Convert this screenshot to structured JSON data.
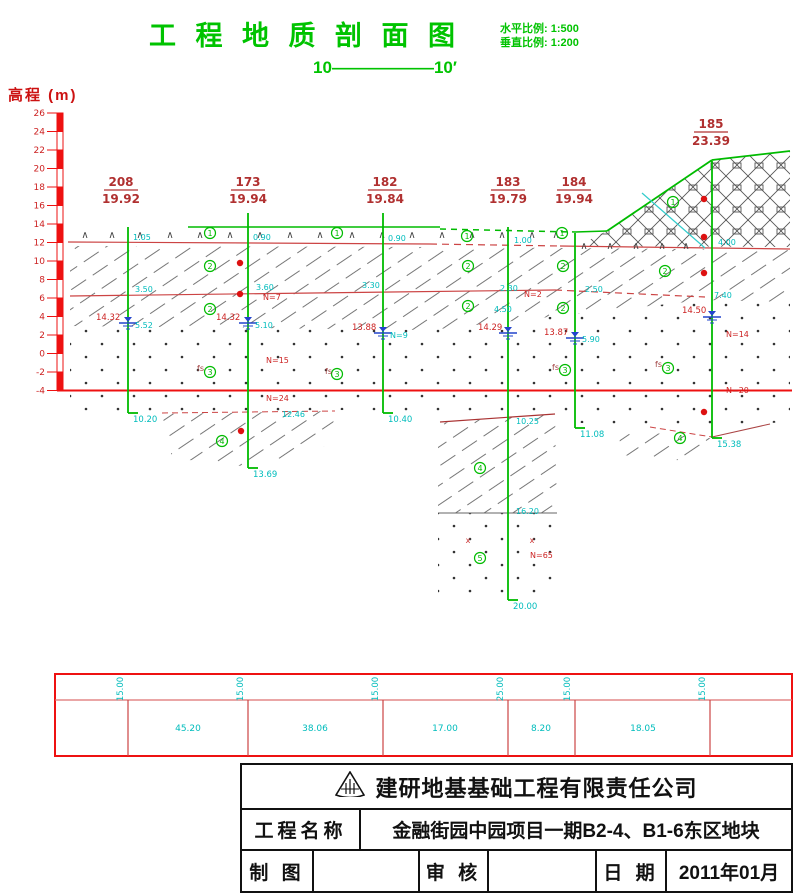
{
  "title": {
    "text": "工 程 地 质 剖 面 图",
    "scale_h": "水平比例: 1:500",
    "scale_v": "垂直比例: 1:200",
    "section": "10——————10′"
  },
  "axis": {
    "label": "高程 (m)",
    "max": 26,
    "min": -4,
    "step": 2,
    "x": 57,
    "bar_w": 6,
    "y_top": 113,
    "px_per_m": 9.25
  },
  "colors": {
    "green": "#00bb00",
    "red_line": "#cc4444",
    "axis_red": "#ee1111",
    "dark_red": "#b03030",
    "cyan": "#00bcbc",
    "blue": "#2244cc",
    "gray": "#666666",
    "table_red": "#ee1111",
    "table_inner": "#dd7070"
  },
  "profile": {
    "boreholes": [
      {
        "id": "208",
        "elev": "19.92",
        "x": 128,
        "lx": 121,
        "ly": 186,
        "top": 227,
        "bottom": 413,
        "depth": "10.20",
        "water": {
          "y": 323,
          "red": "14.32",
          "rx": 96,
          "ry": 320,
          "cyan": "5.52",
          "cx": 135,
          "cy": 328
        }
      },
      {
        "id": "173",
        "elev": "19.94",
        "x": 248,
        "lx": 248,
        "ly": 186,
        "top": 213,
        "bottom": 468,
        "depth": "13.69",
        "water": {
          "y": 323,
          "red": "14.32",
          "rx": 216,
          "ry": 320,
          "cyan": "5.10",
          "cx": 255,
          "cy": 328
        }
      },
      {
        "id": "182",
        "elev": "19.84",
        "x": 383,
        "lx": 385,
        "ly": 186,
        "top": 213,
        "bottom": 413,
        "depth": "10.40",
        "water": {
          "y": 333,
          "red": "13.88",
          "rx": 352,
          "ry": 330,
          "cyan": "N=9",
          "cx": 390,
          "cy": 338
        }
      },
      {
        "id": "183",
        "elev": "19.79",
        "x": 508,
        "lx": 508,
        "ly": 186,
        "top": 227,
        "bottom": 600,
        "depth": "20.00",
        "water": {
          "y": 333,
          "red": "14.29",
          "rx": 478,
          "ry": 330,
          "cyan": "",
          "cx": 0,
          "cy": 0
        }
      },
      {
        "id": "184",
        "elev": "19.94",
        "x": 575,
        "lx": 574,
        "ly": 186,
        "top": 233,
        "bottom": 428,
        "depth": "11.08",
        "water": {
          "y": 338,
          "red": "13.87",
          "rx": 544,
          "ry": 335,
          "cyan": "5.90",
          "cx": 582,
          "cy": 342
        }
      },
      {
        "id": "185",
        "elev": "23.39",
        "x": 712,
        "lx": 711,
        "ly": 128,
        "top": 161,
        "bottom": 438,
        "depth": "15.38",
        "water": {
          "y": 317,
          "red": "14.50",
          "rx": 682,
          "ry": 313,
          "cyan": "",
          "cx": 0,
          "cy": 0
        }
      }
    ],
    "regions": [
      {
        "pat": "pat-clay",
        "pts": [
          [
            70,
            246
          ],
          [
            430,
            247
          ],
          [
            560,
            248
          ],
          [
            790,
            250
          ],
          [
            790,
            302
          ],
          [
            705,
            300
          ],
          [
            640,
            307
          ],
          [
            430,
            330
          ],
          [
            70,
            326
          ]
        ]
      },
      {
        "pat": "pat-sand",
        "pts": [
          [
            70,
            326
          ],
          [
            430,
            330
          ],
          [
            640,
            307
          ],
          [
            705,
            300
          ],
          [
            790,
            303
          ],
          [
            790,
            422
          ],
          [
            712,
            426
          ],
          [
            650,
            426
          ],
          [
            558,
            422
          ],
          [
            554,
            412
          ],
          [
            335,
            410
          ],
          [
            162,
            412
          ],
          [
            70,
            410
          ]
        ]
      },
      {
        "pat": "pat-clay",
        "pts": [
          [
            162,
            414
          ],
          [
            335,
            411
          ],
          [
            330,
            445
          ],
          [
            250,
            467
          ],
          [
            172,
            458
          ]
        ]
      },
      {
        "pat": "pat-clay",
        "pts": [
          [
            438,
            423
          ],
          [
            555,
            414
          ],
          [
            557,
            513
          ],
          [
            438,
            513
          ]
        ]
      },
      {
        "pat": "pat-sand",
        "pts": [
          [
            438,
            513
          ],
          [
            557,
            513
          ],
          [
            557,
            600
          ],
          [
            438,
            600
          ]
        ]
      },
      {
        "pat": "pat-clay",
        "pts": [
          [
            618,
            430
          ],
          [
            710,
            438
          ],
          [
            698,
            462
          ],
          [
            622,
            455
          ]
        ]
      },
      {
        "pat": "pat-cross",
        "pts": [
          [
            577,
            246
          ],
          [
            607,
            231
          ],
          [
            712,
            160
          ],
          [
            790,
            151
          ],
          [
            790,
            247
          ]
        ]
      }
    ],
    "lines": [
      {
        "c": "#00bb00",
        "w": 1.5,
        "pts": [
          [
            188,
            227
          ],
          [
            440,
            227
          ]
        ]
      },
      {
        "c": "#00bb00",
        "w": 1.5,
        "d": "6 5",
        "pts": [
          [
            440,
            229
          ],
          [
            575,
            232
          ]
        ]
      },
      {
        "c": "#00bb00",
        "w": 1.5,
        "pts": [
          [
            575,
            232
          ],
          [
            607,
            231
          ]
        ]
      },
      {
        "c": "#00bb00",
        "w": 1.8,
        "pts": [
          [
            607,
            231
          ],
          [
            712,
            160
          ]
        ]
      },
      {
        "c": "#00bb00",
        "w": 1.8,
        "pts": [
          [
            712,
            160
          ],
          [
            790,
            151
          ]
        ]
      },
      {
        "c": "#cc4444",
        "w": 1.2,
        "pts": [
          [
            68,
            242
          ],
          [
            430,
            244
          ]
        ]
      },
      {
        "c": "#cc4444",
        "w": 1.2,
        "d": "7 5",
        "pts": [
          [
            430,
            244
          ],
          [
            560,
            246
          ]
        ]
      },
      {
        "c": "#cc4444",
        "w": 1.2,
        "pts": [
          [
            560,
            246
          ],
          [
            790,
            249
          ]
        ]
      },
      {
        "c": "#cc4444",
        "w": 1.2,
        "pts": [
          [
            70,
            296
          ],
          [
            555,
            290
          ]
        ]
      },
      {
        "c": "#cc4444",
        "w": 1.2,
        "d": "7 5",
        "pts": [
          [
            555,
            290
          ],
          [
            705,
            297
          ]
        ]
      },
      {
        "c": "#cc4444",
        "w": 1,
        "d": "6 4",
        "pts": [
          [
            162,
            413
          ],
          [
            335,
            411
          ]
        ]
      },
      {
        "c": "#aa3333",
        "w": 1.2,
        "pts": [
          [
            440,
            422
          ],
          [
            555,
            414
          ]
        ]
      },
      {
        "c": "#cc4444",
        "w": 1,
        "d": "6 4",
        "pts": [
          [
            650,
            427
          ],
          [
            712,
            437
          ]
        ]
      },
      {
        "c": "#aa4444",
        "w": 1,
        "pts": [
          [
            712,
            437
          ],
          [
            770,
            424
          ]
        ]
      },
      {
        "c": "#666666",
        "w": 1,
        "pts": [
          [
            438,
            513
          ],
          [
            557,
            513
          ]
        ]
      },
      {
        "c": "#33cccc",
        "w": 1.2,
        "pts": [
          [
            642,
            193
          ],
          [
            705,
            248
          ]
        ]
      }
    ],
    "carets": [
      {
        "y": 238,
        "xs": [
          85,
          112,
          140,
          170,
          200,
          230,
          260,
          290,
          320,
          352,
          382,
          412,
          442,
          472,
          502,
          532,
          556
        ]
      },
      {
        "y": 249,
        "xs": [
          584,
          610,
          636,
          662,
          686
        ]
      }
    ],
    "circles": [
      {
        "n": "1",
        "x": 210,
        "y": 233
      },
      {
        "n": "1",
        "x": 337,
        "y": 233
      },
      {
        "n": "1",
        "x": 467,
        "y": 236
      },
      {
        "n": "1",
        "x": 562,
        "y": 233
      },
      {
        "n": "1",
        "x": 673,
        "y": 202
      },
      {
        "n": "2",
        "x": 210,
        "y": 266
      },
      {
        "n": "2",
        "x": 210,
        "y": 309
      },
      {
        "n": "2",
        "x": 468,
        "y": 266
      },
      {
        "n": "2",
        "x": 468,
        "y": 306
      },
      {
        "n": "2",
        "x": 563,
        "y": 266
      },
      {
        "n": "2",
        "x": 563,
        "y": 308
      },
      {
        "n": "2",
        "x": 665,
        "y": 271
      },
      {
        "n": "3",
        "x": 210,
        "y": 372
      },
      {
        "n": "3",
        "x": 337,
        "y": 374
      },
      {
        "n": "3",
        "x": 565,
        "y": 370
      },
      {
        "n": "3",
        "x": 668,
        "y": 368
      },
      {
        "n": "4",
        "x": 222,
        "y": 441
      },
      {
        "n": "4",
        "x": 480,
        "y": 468
      },
      {
        "n": "4",
        "x": 680,
        "y": 438
      },
      {
        "n": "5",
        "x": 480,
        "y": 558
      }
    ],
    "dots": [
      [
        240,
        263
      ],
      [
        240,
        294
      ],
      [
        241,
        431
      ],
      [
        704,
        199
      ],
      [
        704,
        237
      ],
      [
        704,
        273
      ],
      [
        704,
        412
      ]
    ],
    "xmarks": [
      [
        468,
        543
      ],
      [
        532,
        543
      ]
    ],
    "annotations": [
      {
        "x": 133,
        "y": 240,
        "t": "1.05",
        "c": "cy"
      },
      {
        "x": 135,
        "y": 292,
        "t": "3.50",
        "c": "cy"
      },
      {
        "x": 253,
        "y": 240,
        "t": "0.90",
        "c": "cy"
      },
      {
        "x": 256,
        "y": 290,
        "t": "3.60",
        "c": "cy"
      },
      {
        "x": 388,
        "y": 241,
        "t": "0.90",
        "c": "cy"
      },
      {
        "x": 362,
        "y": 288,
        "t": "3.30",
        "c": "cy"
      },
      {
        "x": 514,
        "y": 243,
        "t": "1.00",
        "c": "cy"
      },
      {
        "x": 500,
        "y": 291,
        "t": "2.30",
        "c": "cy"
      },
      {
        "x": 585,
        "y": 292,
        "t": "2.50",
        "c": "cy"
      },
      {
        "x": 718,
        "y": 245,
        "t": "4.00",
        "c": "cy"
      },
      {
        "x": 714,
        "y": 298,
        "t": "7.40",
        "c": "cy"
      },
      {
        "x": 494,
        "y": 312,
        "t": "4.50",
        "c": "cy"
      },
      {
        "x": 282,
        "y": 417,
        "t": "12.46",
        "c": "cy"
      },
      {
        "x": 516,
        "y": 424,
        "t": "10.25",
        "c": "cy"
      },
      {
        "x": 516,
        "y": 514,
        "t": "16.20",
        "c": "cy"
      },
      {
        "x": 263,
        "y": 300,
        "t": "N=7",
        "c": "rd"
      },
      {
        "x": 524,
        "y": 297,
        "t": "N=2",
        "c": "rd"
      },
      {
        "x": 266,
        "y": 363,
        "t": "N=15",
        "c": "rd"
      },
      {
        "x": 266,
        "y": 401,
        "t": "N=24",
        "c": "rd"
      },
      {
        "x": 726,
        "y": 337,
        "t": "N=14",
        "c": "rd"
      },
      {
        "x": 726,
        "y": 393,
        "t": "N=20",
        "c": "rd"
      },
      {
        "x": 530,
        "y": 558,
        "t": "N=65",
        "c": "rd"
      },
      {
        "x": 197,
        "y": 371,
        "t": "fs",
        "c": "dr"
      },
      {
        "x": 325,
        "y": 374,
        "t": "fs",
        "c": "dr"
      },
      {
        "x": 552,
        "y": 370,
        "t": "fs",
        "c": "dr"
      },
      {
        "x": 655,
        "y": 367,
        "t": "fs",
        "c": "dr"
      }
    ]
  },
  "distance_table": {
    "x": 55,
    "y": 674,
    "w": 737,
    "h": 82,
    "div_y": 700,
    "columns": [
      128,
      248,
      383,
      508,
      575,
      710
    ],
    "vertical_values": [
      "15.00",
      "15.00",
      "15.00",
      "25.00",
      "15.00",
      "15.00"
    ],
    "spans": [
      {
        "cx": 188,
        "t": "45.20"
      },
      {
        "cx": 315,
        "t": "38.06"
      },
      {
        "cx": 445,
        "t": "17.00"
      },
      {
        "cx": 541,
        "t": "8.20"
      },
      {
        "cx": 643,
        "t": "18.05"
      }
    ]
  },
  "title_block": {
    "company": "建研地基基础工程有限责任公司",
    "project_label": "工程名称",
    "project": "金融街园中园项目一期B2-4、B1-6东区地块",
    "drafter_label": "制 图",
    "reviewer_label": "审 核",
    "date_label": "日 期",
    "date": "2011年01月"
  }
}
